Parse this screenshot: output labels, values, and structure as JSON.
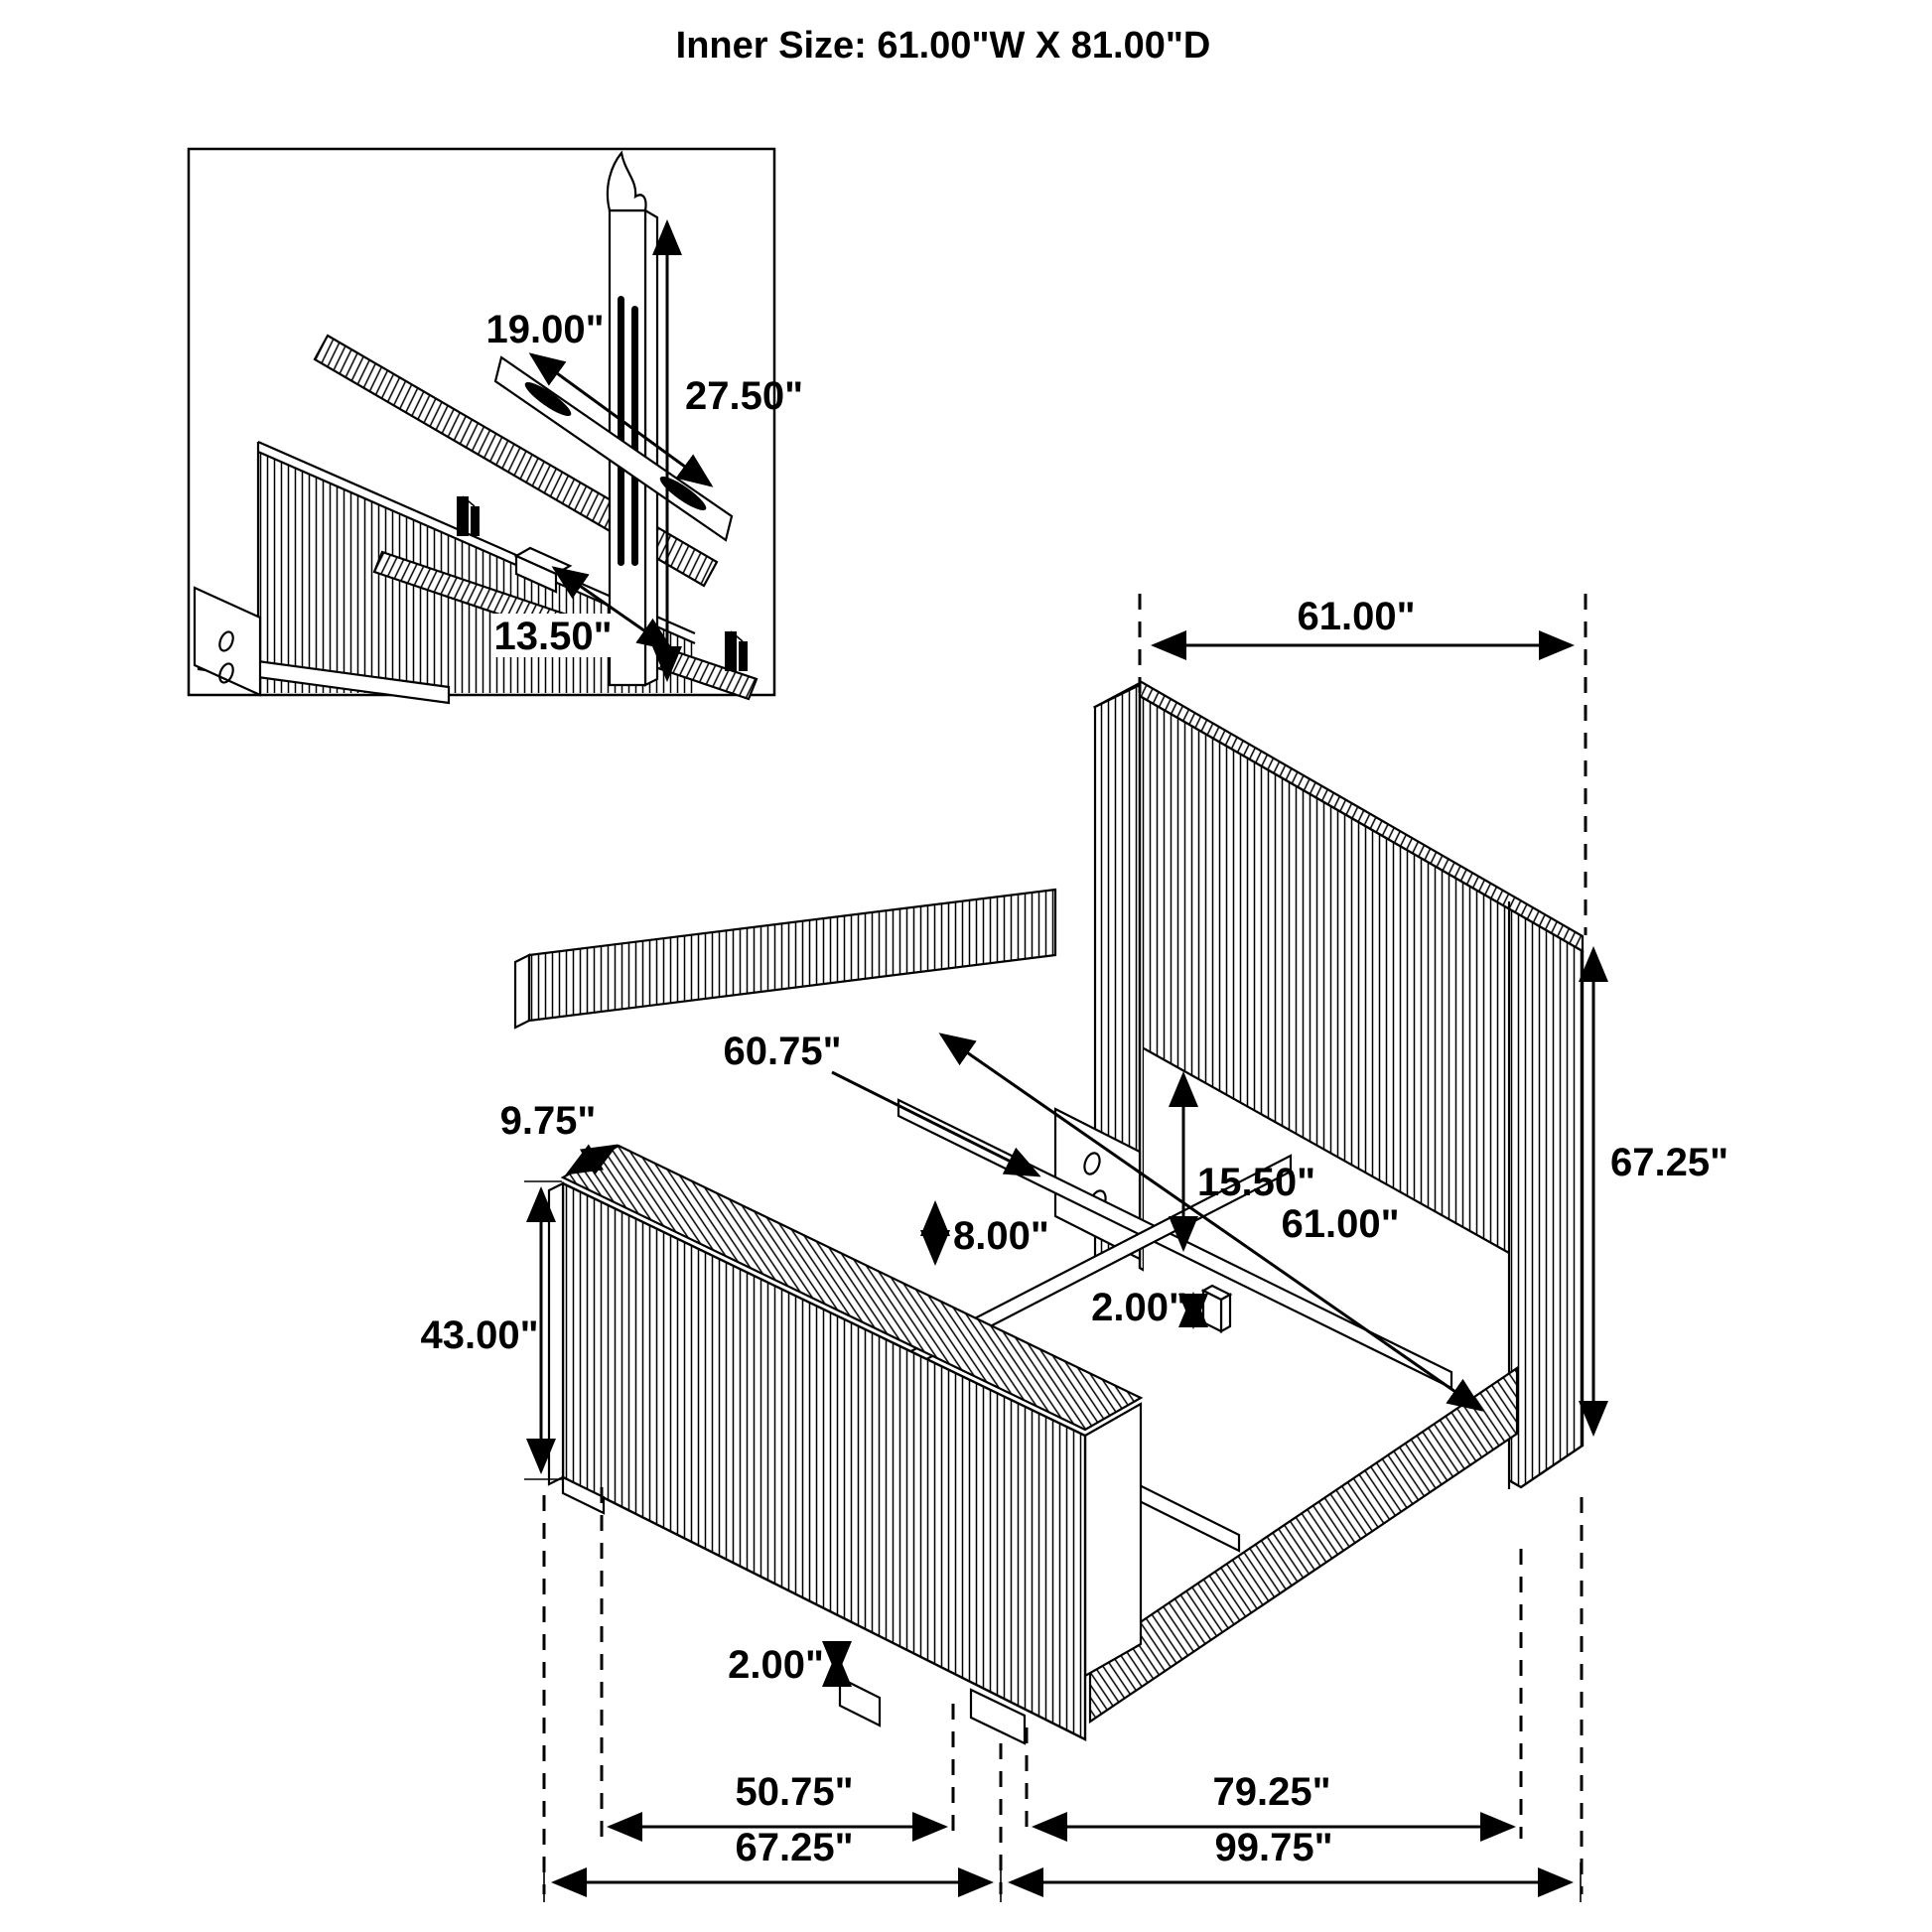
{
  "title": "Inner Size: 61.00\"W X 81.00\"D",
  "dimensions": {
    "inset": {
      "bracket_bar_width": "19.00\"",
      "bracket_height": "27.50\"",
      "mount_spacing": "13.50\""
    },
    "main": {
      "headboard_width": "61.00\"",
      "headboard_height": "67.25\"",
      "slat_length": "60.75\"",
      "footboard_top_depth": "9.75\"",
      "headboard_panel_clearance": "15.50\"",
      "inner_width": "61.00\"",
      "rail_slat_gap": "8.00\"",
      "center_leg_size": "2.00\"",
      "footboard_height": "43.00\"",
      "foot_leg_height": "2.00\"",
      "footboard_inner_width": "50.75\"",
      "rail_length": "79.25\"",
      "footboard_outer_width": "67.25\"",
      "overall_length": "99.75\""
    }
  }
}
